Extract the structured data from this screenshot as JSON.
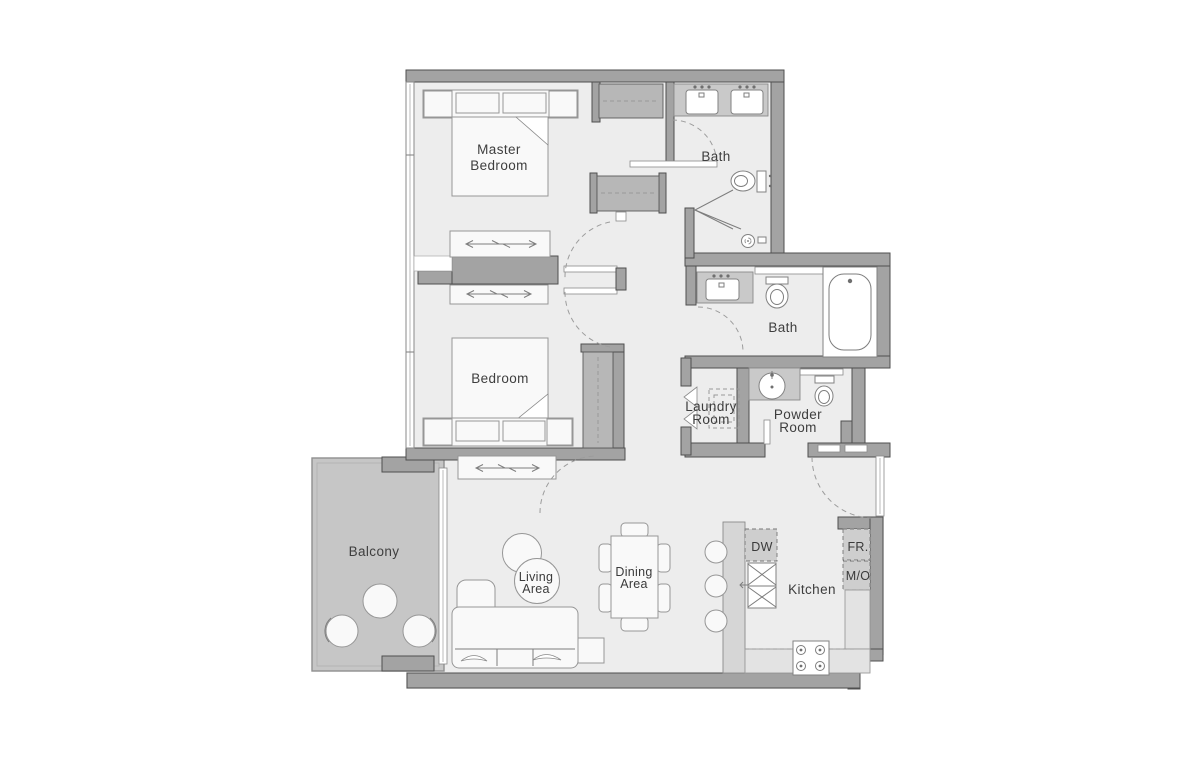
{
  "plan": {
    "colors": {
      "wall": "#a3a3a3",
      "wall_edge": "#4f4f4f",
      "floor": "#ededed",
      "balcony_floor": "#c6c6c6",
      "closet": "#b7b7b7",
      "counter": "#c9c9c9",
      "furniture": "#f9f9f9",
      "label_text": "#3e3e3e"
    },
    "rooms": {
      "master_bedroom": {
        "label_line1": "Master",
        "label_line2": "Bedroom"
      },
      "bath_top": {
        "label": "Bath"
      },
      "bedroom": {
        "label": "Bedroom"
      },
      "bath_middle": {
        "label": "Bath"
      },
      "laundry_room": {
        "label_line1": "Laundry",
        "label_line2": "Room"
      },
      "powder_room": {
        "label_line1": "Powder",
        "label_line2": "Room"
      },
      "balcony": {
        "label": "Balcony"
      },
      "living_area": {
        "label_line1": "Living",
        "label_line2": "Area"
      },
      "dining_area": {
        "label_line1": "Dining",
        "label_line2": "Area"
      },
      "kitchen": {
        "label": "Kitchen"
      }
    },
    "appliances": {
      "dishwasher": {
        "label": "DW"
      },
      "fridge": {
        "label": "FR."
      },
      "microwave_oven": {
        "label": "M/O"
      }
    }
  }
}
